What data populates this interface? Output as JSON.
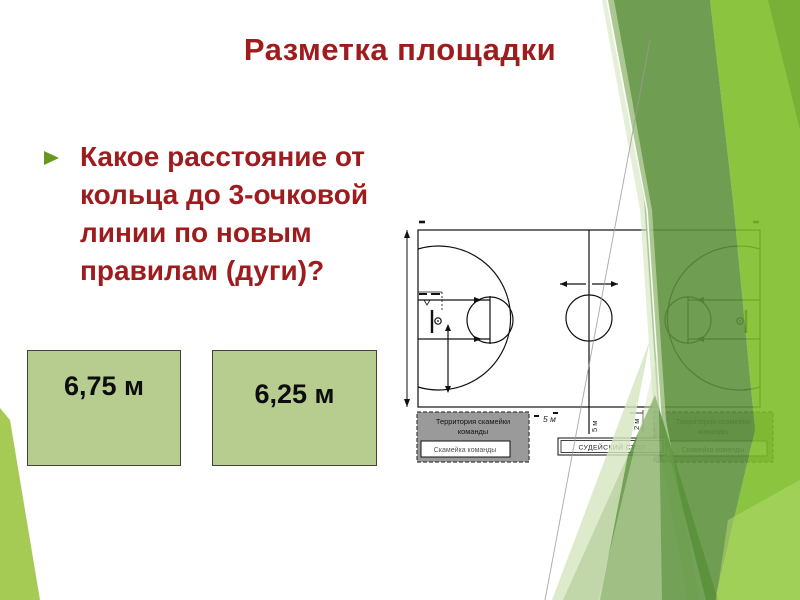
{
  "slide": {
    "title": "Разметка площадки"
  },
  "question": {
    "text": "Какое расстояние от\nкольца до 3-очковой\nлинии по новым\nправилам (дуги)?"
  },
  "answers": [
    {
      "label": "6,75 м"
    },
    {
      "label": "6,25 м"
    }
  ],
  "diagram": {
    "bench_area_line1": "Территория скамейки",
    "bench_area_line2": "команды",
    "bench_label": "Скамейка команды",
    "referee_table_label": "СУДЕЙСКИЙ СТОЛ",
    "dim_5m": "5 м",
    "dim_5m_vertical": "5 м",
    "dim_2m_vertical": "2 м"
  },
  "colors": {
    "title_red": "#9E1B1E",
    "bullet_green": "#69961E",
    "answer_box_fill": "#B7CD8F",
    "decor_bright_green": "#8CC63F",
    "decor_medium_green": "#6F9E52",
    "decor_pale_green": "#D6E6C0",
    "decor_wedge_green": "#A6CB55",
    "bench_box_gray": "#9A9A9A"
  }
}
